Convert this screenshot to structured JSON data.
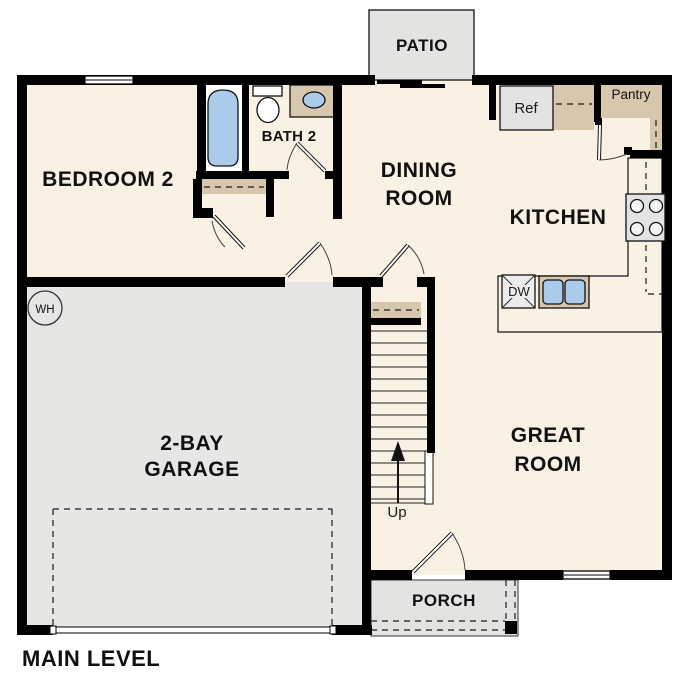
{
  "plan": {
    "title": "MAIN LEVEL"
  },
  "rooms": {
    "bedroom2": {
      "label": "BEDROOM 2"
    },
    "bath2": {
      "label": "BATH 2"
    },
    "dining": {
      "line1": "DINING",
      "line2": "ROOM"
    },
    "kitchen": {
      "label": "KITCHEN"
    },
    "great_room": {
      "line1": "GREAT",
      "line2": "ROOM"
    },
    "garage": {
      "line1": "2-BAY",
      "line2": "GARAGE"
    },
    "patio": {
      "label": "PATIO"
    },
    "porch": {
      "label": "PORCH"
    },
    "pantry": {
      "label": "Pantry"
    }
  },
  "fixtures": {
    "refrigerator": "Ref",
    "dishwasher": "DW",
    "water_heater": "WH",
    "stairs_direction": "Up"
  },
  "colors": {
    "floor": "#f8f1e4",
    "garage": "#e6e6e4",
    "exterior": "#e3e3e1",
    "counter": "#d6c7ad",
    "fixture_blue": "#abcbea",
    "appliance_gray": "#e3e3e3",
    "wall": "#000000"
  }
}
